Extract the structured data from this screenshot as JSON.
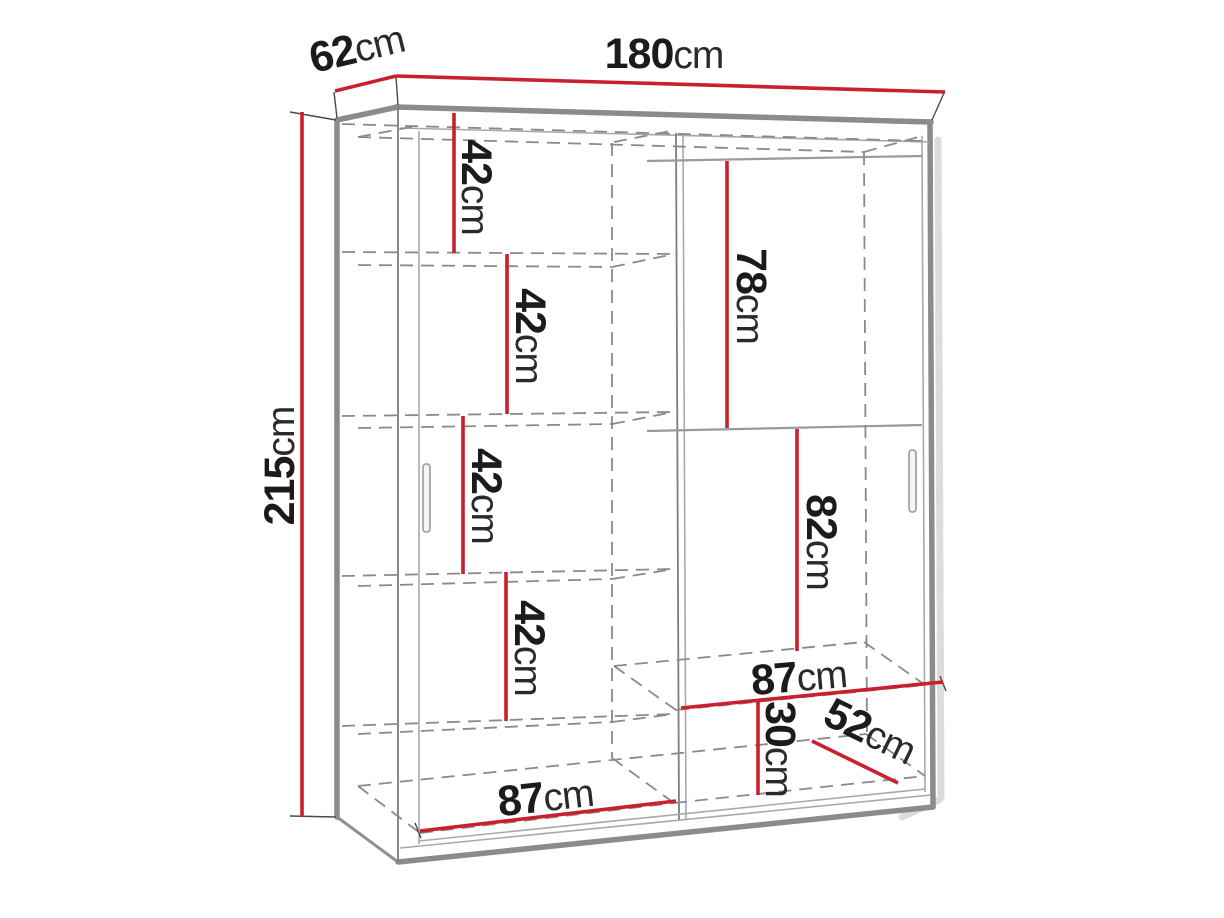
{
  "figure": {
    "kind": "wardrobe-dimension-diagram",
    "description": "Sliding-door wardrobe technical drawing with red dimension lines"
  },
  "colors": {
    "dimension_red": "#c8202e",
    "carcass_gray": "#8b8b8b",
    "hidden_line_gray": "#8a8a8a",
    "label_black": "#1b1b1b",
    "background": "#ffffff"
  },
  "dimensions": {
    "width_top": {
      "value": "180",
      "unit": "cm"
    },
    "depth_top": {
      "value": "62",
      "unit": "cm"
    },
    "height_left": {
      "value": "215",
      "unit": "cm"
    },
    "shelf_gaps": [
      {
        "value": "42",
        "unit": "cm"
      },
      {
        "value": "42",
        "unit": "cm"
      },
      {
        "value": "42",
        "unit": "cm"
      },
      {
        "value": "42",
        "unit": "cm"
      }
    ],
    "right_top_section": {
      "value": "78",
      "unit": "cm"
    },
    "right_middle_section": {
      "value": "82",
      "unit": "cm"
    },
    "right_shelf_width": {
      "value": "87",
      "unit": "cm"
    },
    "right_bottom_height": {
      "value": "30",
      "unit": "cm"
    },
    "bottom_depth": {
      "value": "52",
      "unit": "cm"
    },
    "left_floor_width": {
      "value": "87",
      "unit": "cm"
    }
  }
}
